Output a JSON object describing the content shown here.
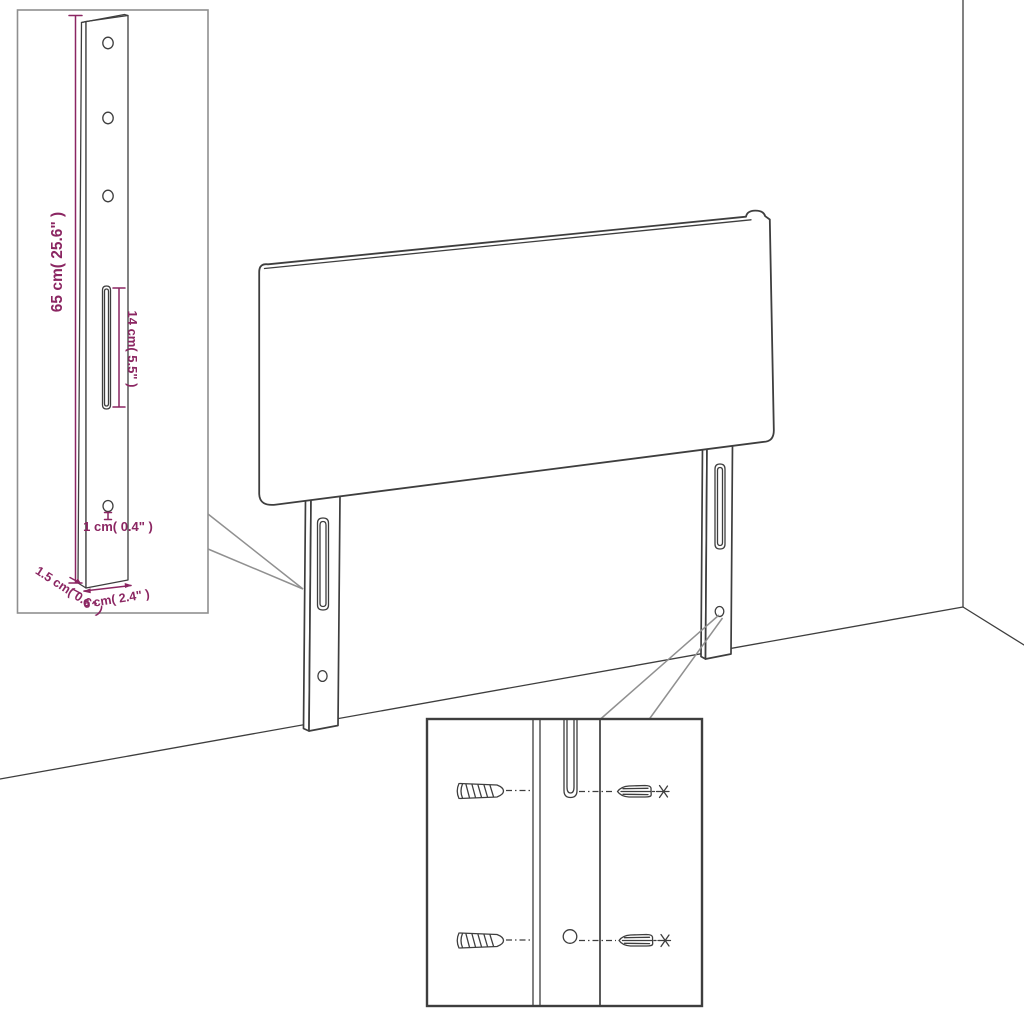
{
  "labels": {
    "post_height": "65 cm( 25.6\" )",
    "slot_length": "14 cm( 5.5\" )",
    "hole_diameter": "1 cm( 0.4\" )",
    "board_thickness": "1.5 cm( 0.6\" )",
    "leg_width": "6 cm( 2.4\" )"
  },
  "colors": {
    "dimension_text": "#8B2662",
    "line_art": "#3E3E3E",
    "callout": "#909090",
    "inset_border_light": "#8F8F8F",
    "inset_border_dark": "#3E3E3E",
    "background": "#FFFFFF"
  }
}
